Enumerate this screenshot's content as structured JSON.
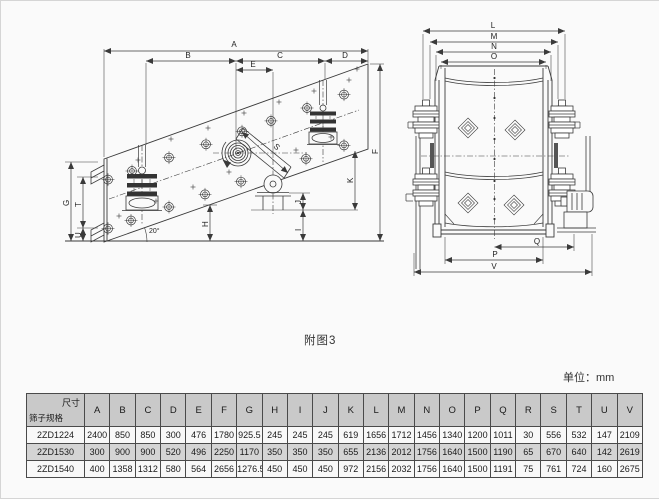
{
  "drawing": {
    "caption": "附图3",
    "unit": "单位：mm",
    "side_view": {
      "labels": {
        "A": "A",
        "B": "B",
        "C": "C",
        "D": "D",
        "E": "E",
        "F": "F",
        "G": "G",
        "H": "H",
        "I": "I",
        "J": "J",
        "K": "K",
        "S": "S",
        "T": "T",
        "U": "U"
      },
      "angle": "20°"
    },
    "front_view": {
      "labels": {
        "L": "L",
        "M": "M",
        "N": "N",
        "O": "O",
        "P": "P",
        "Q": "Q",
        "V": "V"
      }
    }
  },
  "colors": {
    "line": "#3a3a3a",
    "table_header_bg": "#c9c9c9",
    "table_alt_row_bg": "#d4d4d4",
    "page_bg": "#fafafa"
  },
  "table": {
    "corner": {
      "top_right": "尺寸",
      "bottom_left": "筛子规格"
    },
    "columns": [
      "A",
      "B",
      "C",
      "D",
      "E",
      "F",
      "G",
      "H",
      "I",
      "J",
      "K",
      "L",
      "M",
      "N",
      "O",
      "P",
      "Q",
      "R",
      "S",
      "T",
      "U",
      "V"
    ],
    "rows": [
      {
        "model": "2ZD1224",
        "values": [
          2400,
          850,
          850,
          300,
          476,
          1780,
          925.5,
          245,
          245,
          245,
          619,
          1656,
          1712,
          1456,
          1340,
          1200,
          1011,
          30,
          556,
          532,
          147,
          2109
        ]
      },
      {
        "model": "2ZD1530",
        "values": [
          300,
          900,
          900,
          520,
          496,
          2250,
          1170,
          350,
          350,
          350,
          655,
          2136,
          2012,
          1756,
          1640,
          1500,
          1190,
          65,
          670,
          640,
          142,
          2619
        ]
      },
      {
        "model": "2ZD1540",
        "values": [
          400,
          1358,
          1312,
          580,
          564,
          2656,
          1276.5,
          450,
          450,
          450,
          972,
          2156,
          2032,
          1756,
          1640,
          1500,
          1191,
          75,
          761,
          724,
          160,
          2675
        ]
      }
    ]
  }
}
